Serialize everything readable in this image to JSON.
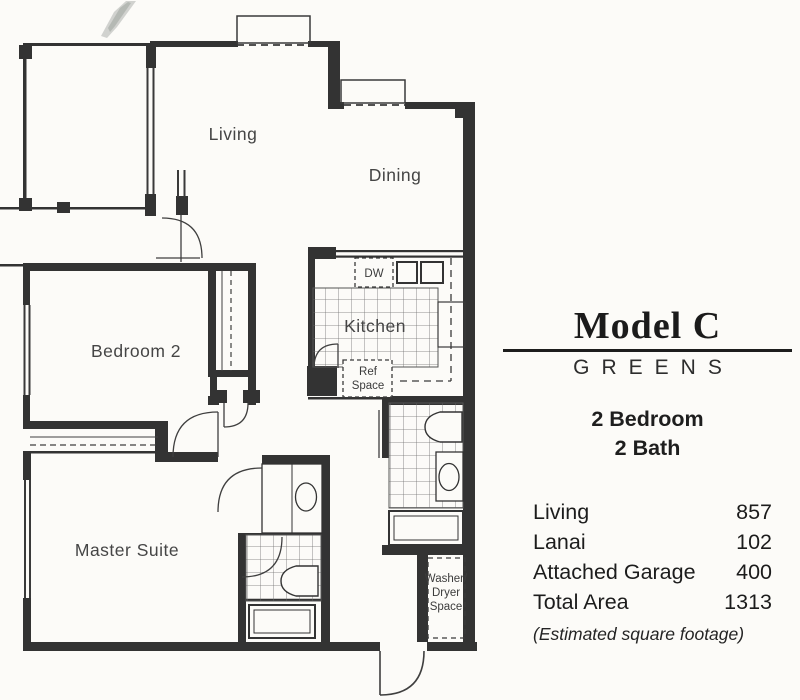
{
  "plan": {
    "rooms": {
      "living": "Living",
      "dining": "Dining",
      "kitchen": "Kitchen",
      "bedroom2": "Bedroom 2",
      "master": "Master Suite"
    },
    "fixtures": {
      "dishwasher": "DW",
      "ref_line1": "Ref",
      "ref_line2": "Space",
      "wd_line1": "Washer/",
      "wd_line2": "Dryer",
      "wd_line3": "Space"
    },
    "colors": {
      "wall": "#333333",
      "paper": "#fcfbf8",
      "label_text": "#454545"
    }
  },
  "panel": {
    "model": "Model C",
    "community": "GREENS",
    "config_line1": "2 Bedroom",
    "config_line2": "2 Bath",
    "areas": {
      "rows": [
        {
          "label": "Living",
          "value": "857"
        },
        {
          "label": "Lanai",
          "value": "102"
        },
        {
          "label": "Attached Garage",
          "value": "400"
        },
        {
          "label": "Total Area",
          "value": "1313"
        }
      ],
      "footnote": "(Estimated square footage)"
    }
  }
}
